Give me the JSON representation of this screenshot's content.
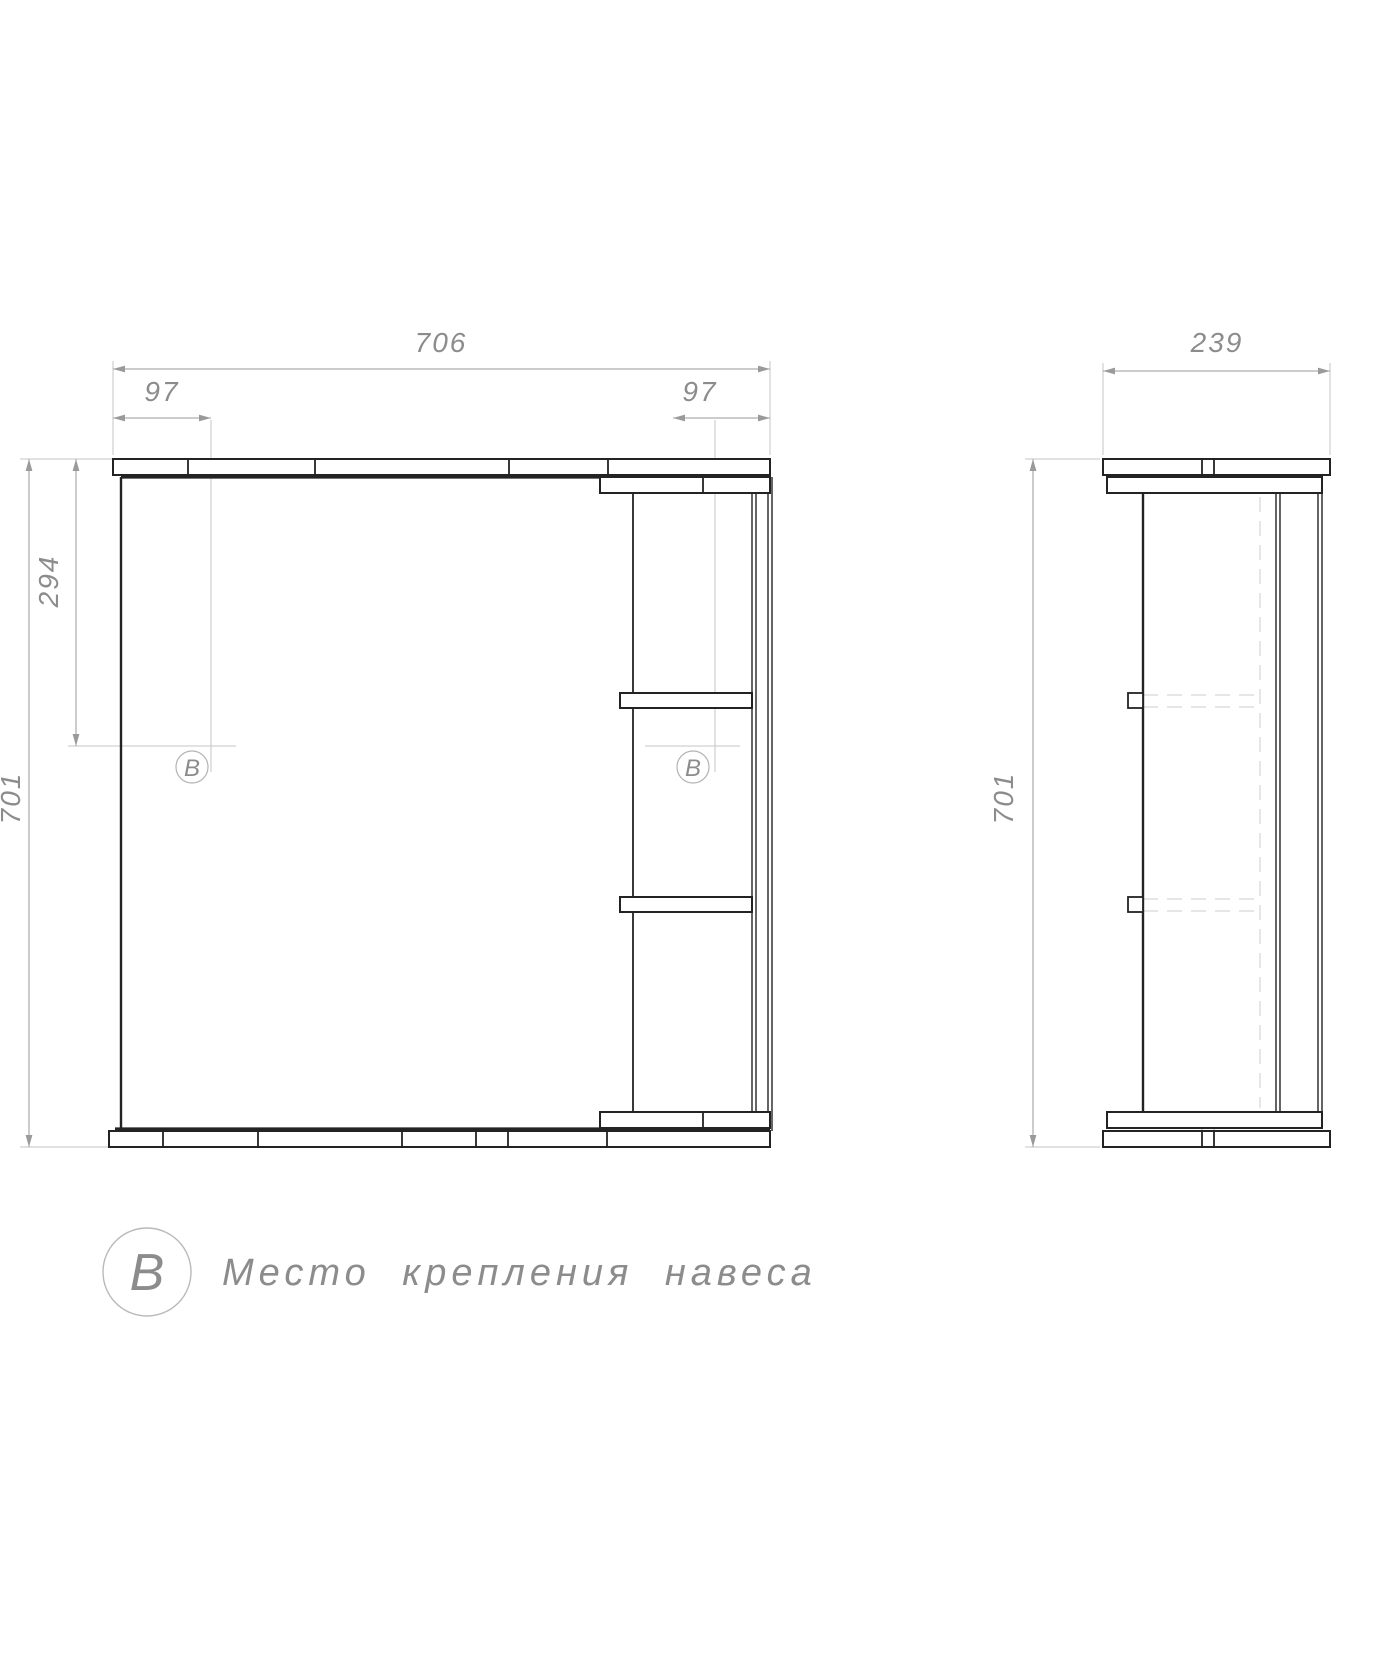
{
  "drawing": {
    "front_view": {
      "dim_width": "706",
      "dim_offset_left": "97",
      "dim_offset_right": "97",
      "dim_bracket_drop": "294",
      "dim_height": "701",
      "marker_symbol": "B"
    },
    "side_view": {
      "dim_depth": "239",
      "dim_height": "701"
    },
    "legend": {
      "symbol": "B",
      "label": "Место крепления навеса"
    },
    "colors": {
      "object": "#232323",
      "dim": "#9a9a9a",
      "text": "#8c8c8c",
      "light": "#c6c6c6",
      "hidden": "#d8d8d8",
      "bg": "#ffffff"
    }
  }
}
